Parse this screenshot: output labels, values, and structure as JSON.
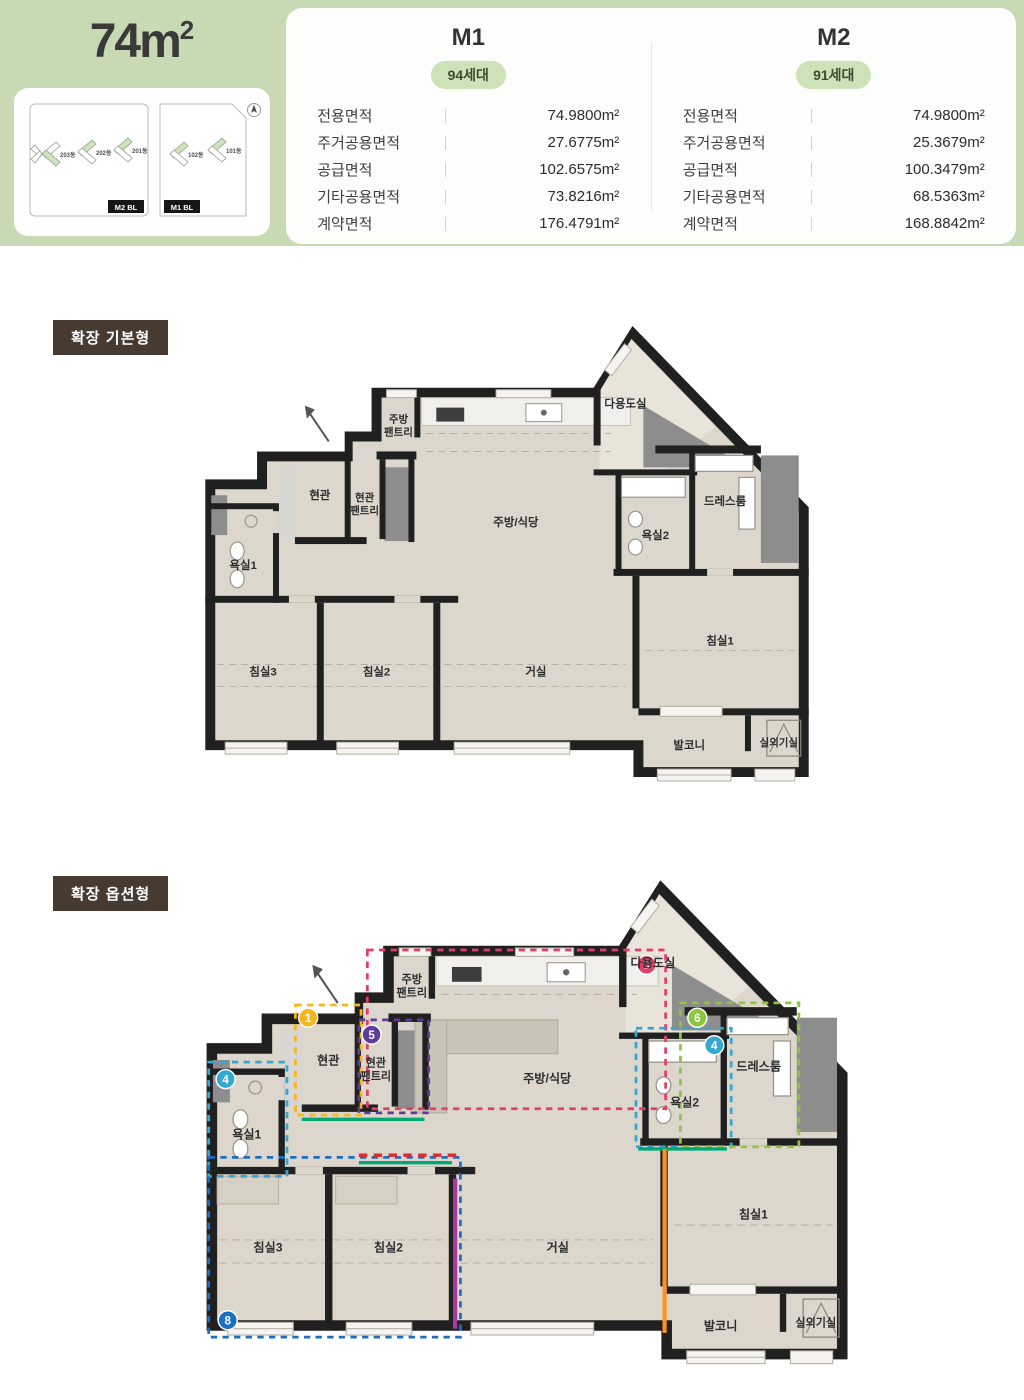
{
  "header": {
    "bg": "#c7dab4",
    "area_title": "74m",
    "area_title_sup": "2",
    "site": {
      "m2_badge": "M2 BL",
      "m1_badge": "M1 BL",
      "m2_buildings": [
        "203동",
        "202동",
        "201동"
      ],
      "m1_buildings": [
        "102동",
        "101동"
      ],
      "compass": "compass-icon"
    },
    "types": [
      {
        "name": "M1",
        "badge": "94세대",
        "rows": [
          {
            "label": "전용면적",
            "value": "74.9800m²"
          },
          {
            "label": "주거공용면적",
            "value": "27.6775m²"
          },
          {
            "label": "공급면적",
            "value": "102.6575m²"
          },
          {
            "label": "기타공용면적",
            "value": "73.8216m²"
          },
          {
            "label": "계약면적",
            "value": "176.4791m²"
          }
        ]
      },
      {
        "name": "M2",
        "badge": "91세대",
        "rows": [
          {
            "label": "전용면적",
            "value": "74.9800m²"
          },
          {
            "label": "주거공용면적",
            "value": "25.3679m²"
          },
          {
            "label": "공급면적",
            "value": "100.3479m²"
          },
          {
            "label": "기타공용면적",
            "value": "68.5363m²"
          },
          {
            "label": "계약면적",
            "value": "168.8842m²"
          }
        ]
      }
    ]
  },
  "rooms": {
    "kitchen_pantry_1": "주방",
    "kitchen_pantry_2": "팬트리",
    "entry": "현관",
    "entry_pantry_1": "현관",
    "entry_pantry_2": "팬트리",
    "kitchen_dining": "주방/식당",
    "utility": "다용도실",
    "dress_room": "드레스룸",
    "bath2": "욕실2",
    "bath1": "욕실1",
    "bed3": "침실3",
    "bed2": "침실2",
    "living": "거실",
    "bed1": "침실1",
    "balcony": "발코니",
    "ac_room": "실외기실"
  },
  "plans": [
    {
      "tag": "확장 기본형"
    },
    {
      "tag": "확장 옵션형",
      "markers": [
        {
          "num": "1",
          "color": "#f5b71c"
        },
        {
          "num": "3",
          "color": "#e23f68"
        },
        {
          "num": "4",
          "color": "#35a8d0"
        },
        {
          "num": "5",
          "color": "#5d3f98"
        },
        {
          "num": "6",
          "color": "#8cc63e"
        },
        {
          "num": "8",
          "color": "#1b6ec2"
        }
      ],
      "option_lines": {
        "red": "#dd2b2b",
        "teal": "#00a878",
        "orange": "#f7941d",
        "magenta": "#aa3a9e"
      }
    }
  ]
}
